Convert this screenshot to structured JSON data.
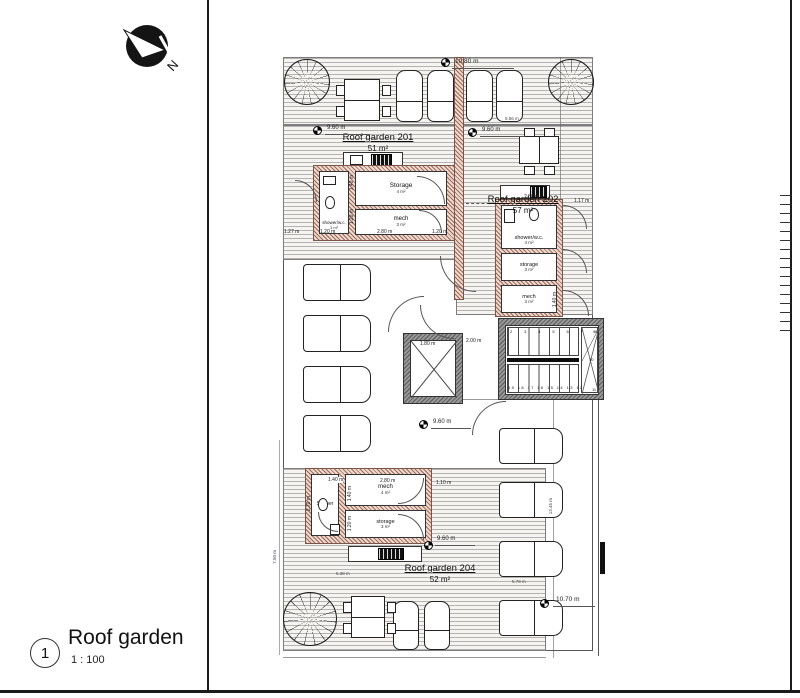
{
  "north": {
    "label": "N"
  },
  "title_block": {
    "number": "1",
    "title": "Roof garden",
    "scale": "1 : 100"
  },
  "gardens": {
    "g201": {
      "name": "Roof garden 201",
      "area": "51 m²"
    },
    "g202": {
      "name": "Roof garden 202",
      "area": "57 m²"
    },
    "g204": {
      "name": "Roof garden 204",
      "area": "52 m²"
    }
  },
  "core201": {
    "shower": "shower/w.c.",
    "shower_area": "3 m²",
    "storage": "Storage",
    "storage_area": "4 m²",
    "mech": "mech",
    "mech_area": "3 m²"
  },
  "core202": {
    "shower": "shower/w.c.",
    "shower_area": "4 m²",
    "storage": "storage",
    "storage_area": "3 m²",
    "mech": "mech",
    "mech_area": "3 m²"
  },
  "core204": {
    "shower": "Shower",
    "mech": "mech",
    "mech_area": "4 m²",
    "storage": "storage",
    "storage_area": "3 m²"
  },
  "stair": {
    "top_run": "2 3 4 5 6 7 8",
    "bottom_run": "19 18 17 16 15 14 13 12",
    "n9": "9",
    "n10": "10",
    "n11": "11"
  },
  "dims": {
    "top": "10.80 m",
    "g201": "9.60 m",
    "g202": "9.60 m",
    "mid": "9.60 m",
    "g204": "9.60 m",
    "bottom": "10.70 m",
    "w556": "5.56 m",
    "w127": "1.27 m",
    "w120a": "1.20 m",
    "w280a": "2.80 m",
    "w120b": "1.20 m",
    "h140a": "1.40 m",
    "h120a": "1.20 m",
    "w280b": "2.80 m",
    "w117": "1.17 m",
    "h140b": "1.40 m",
    "lift": "1.80 m",
    "stairw": "2.00 m",
    "w140c": "1.40 m",
    "w280c": "2.80 m",
    "w110": "1.10 m",
    "h270": "2.70 m",
    "h140d": "1.40 m",
    "h120b": "1.20 m",
    "w638": "6.38 m",
    "h750": "7.50 m",
    "w578": "5.78 m",
    "h1345": "13.45 m"
  }
}
